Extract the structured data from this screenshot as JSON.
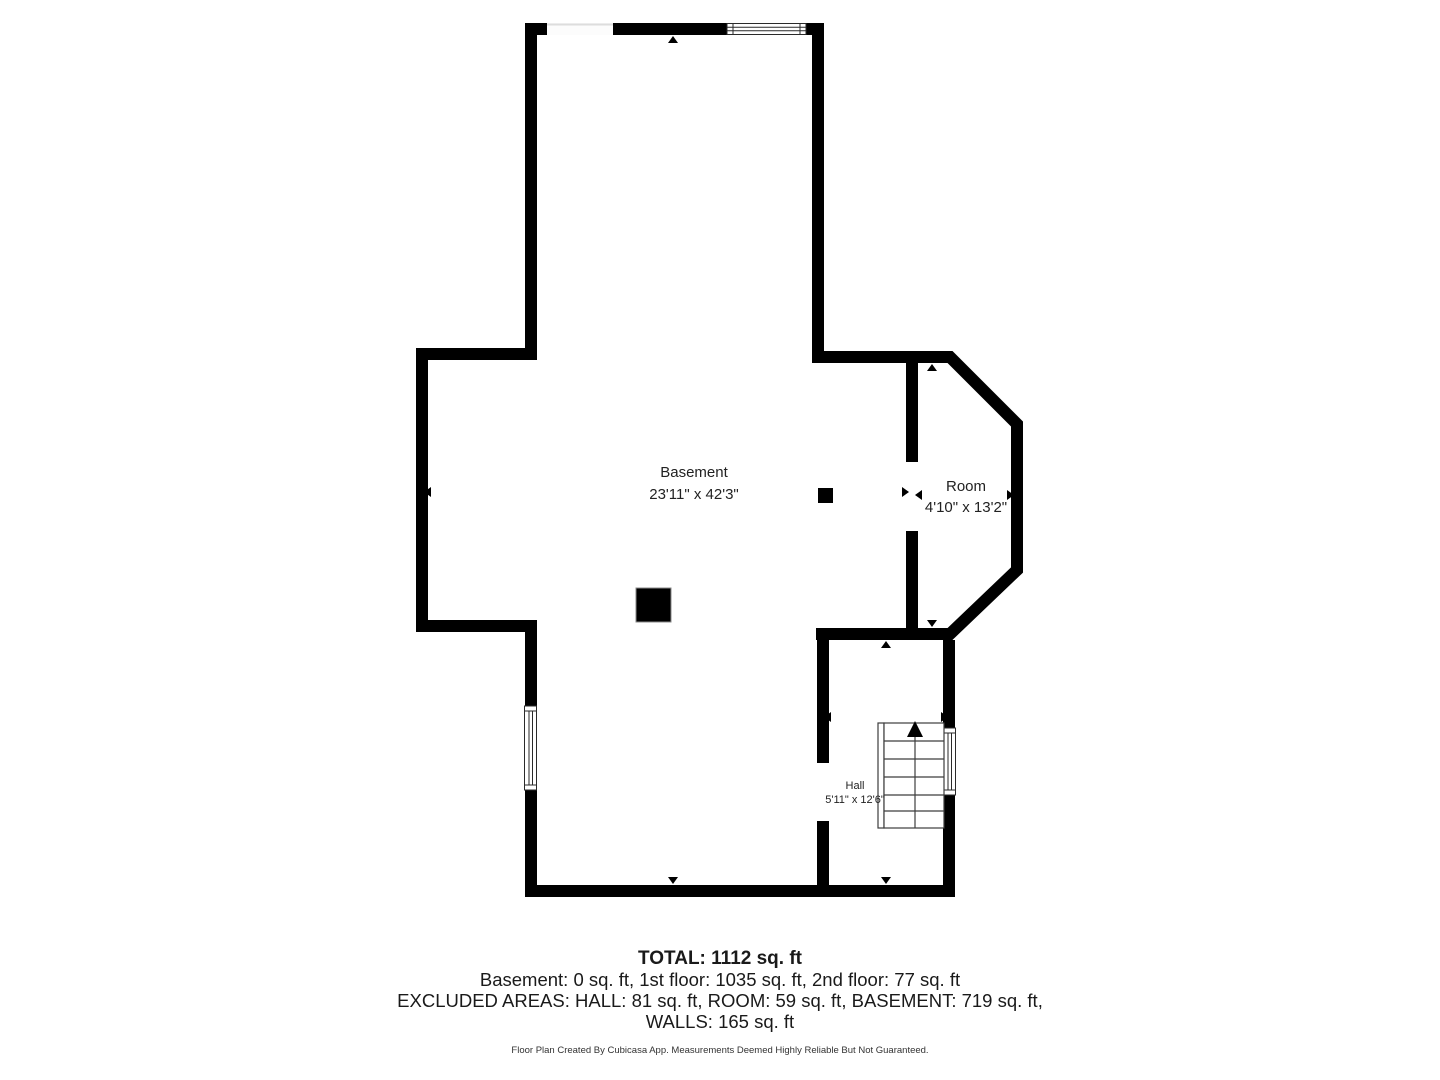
{
  "colors": {
    "wall": "#000000",
    "background": "#ffffff",
    "stairs_line": "#3d3d3d",
    "window_line": "#2a2a2a",
    "opening_line": "#dddddd"
  },
  "rooms": {
    "basement": {
      "name": "Basement",
      "dimensions": "23'11\" x 42'3\""
    },
    "room": {
      "name": "Room",
      "dimensions": "4'10\" x 13'2\""
    },
    "hall": {
      "name": "Hall",
      "dimensions": "5'11\" x 12'6\""
    }
  },
  "summary": {
    "total": "TOTAL: 1112 sq. ft",
    "floors": "Basement: 0 sq. ft, 1st floor: 1035 sq. ft, 2nd floor: 77 sq. ft",
    "excluded": "EXCLUDED AREAS: HALL: 81 sq. ft, ROOM: 59 sq. ft, BASEMENT: 719 sq. ft,",
    "walls": "WALLS: 165 sq. ft"
  },
  "disclaimer": "Floor Plan Created By Cubicasa App. Measurements Deemed Highly Reliable But Not Guaranteed."
}
